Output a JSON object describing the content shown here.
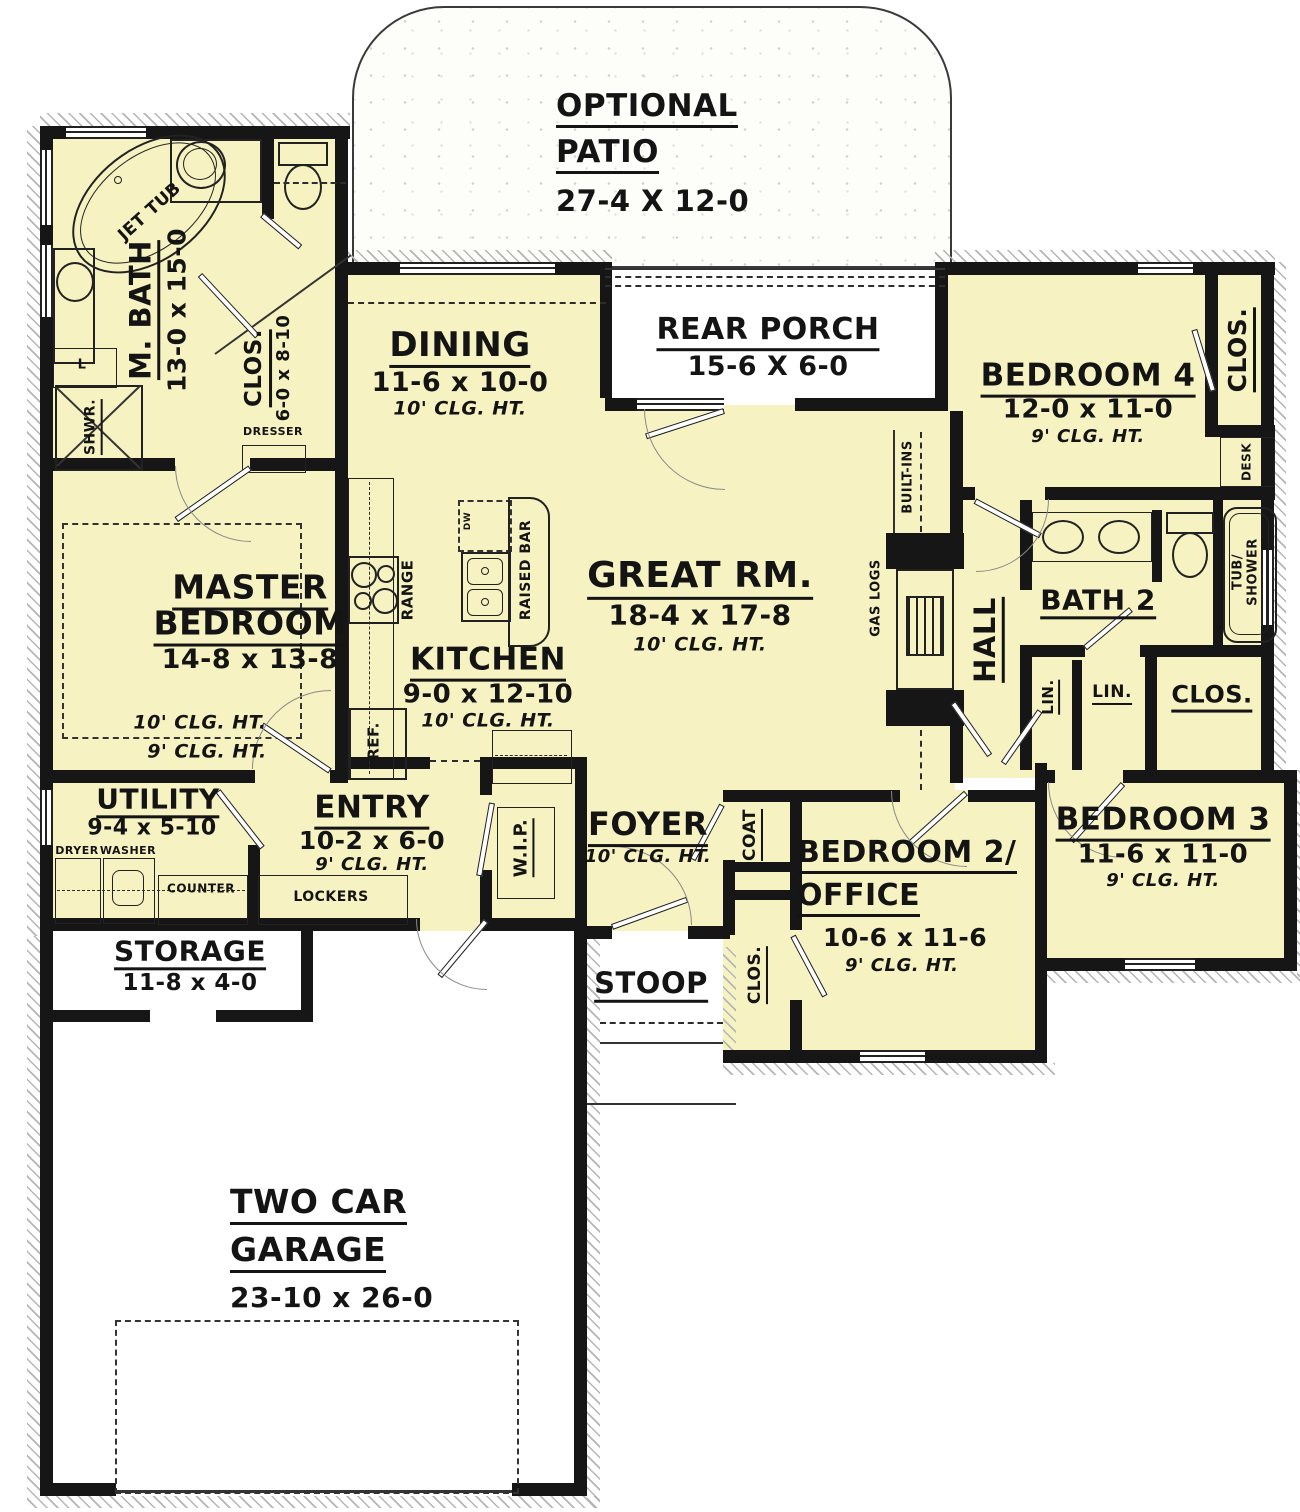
{
  "colors": {
    "room_fill": "#F6F2C2",
    "wall": "#161616",
    "exterior": "#FFFFFF"
  },
  "labels": {
    "patio": {
      "name1": "OPTIONAL",
      "name2": "PATIO",
      "dims": "27-4 X 12-0"
    },
    "mbath": {
      "name": "M. BATH",
      "dims": "13-0 x 15-0"
    },
    "mclos": {
      "name": "CLOS.",
      "dims": "6-0 x 8-10"
    },
    "dresser": "DRESSER",
    "shower": "SHWR.",
    "jettub": "JET TUB",
    "linen_l": "L",
    "master": {
      "name1": "MASTER",
      "name2": "BEDROOM",
      "dims": "14-8 x 13-8",
      "clg10": "10' CLG. HT.",
      "clg9": "9' CLG. HT."
    },
    "dining": {
      "name": "DINING",
      "dims": "11-6 x 10-0",
      "clg": "10' CLG. HT."
    },
    "porch": {
      "name": "REAR PORCH",
      "dims": "15-6 X 6-0"
    },
    "great": {
      "name": "GREAT RM.",
      "dims": "18-4 x 17-8",
      "clg": "10' CLG. HT."
    },
    "kitchen": {
      "name": "KITCHEN",
      "dims": "9-0 x 12-10",
      "clg": "10' CLG. HT."
    },
    "range": "RANGE",
    "ref": "REF.",
    "raisedbar": "RAISED BAR",
    "dw": "DW",
    "builtins": "BUILT-INS",
    "gaslogs": "GAS LOGS",
    "bed4": {
      "name": "BEDROOM 4",
      "dims": "12-0 x 11-0",
      "clg": "9' CLG. HT."
    },
    "bed4clos": "CLOS.",
    "desk": "DESK",
    "bath2": "BATH 2",
    "hall": "HALL",
    "lin1": "LIN.",
    "lin2": "LIN.",
    "hallclos": "CLOS.",
    "tubshower": {
      "line1": "TUB/",
      "line2": "SHOWER"
    },
    "bed3": {
      "name": "BEDROOM 3",
      "dims": "11-6 x 11-0",
      "clg": "9' CLG. HT."
    },
    "bed2": {
      "name1": "BEDROOM 2/",
      "name2": "OFFICE",
      "dims": "10-6 x 11-6",
      "clg": "9' CLG. HT."
    },
    "coat": "COAT",
    "bed2clos": "CLOS.",
    "foyer": {
      "name": "FOYER",
      "clg": "10' CLG. HT."
    },
    "wip": "W.I.P.",
    "entry": {
      "name": "ENTRY",
      "dims": "10-2 x 6-0",
      "clg": "9' CLG. HT."
    },
    "lockers": "LOCKERS",
    "utility": {
      "name": "UTILITY",
      "dims": "9-4 x 5-10"
    },
    "dryer": "DRYER",
    "washer": "WASHER",
    "counter": "COUNTER",
    "storage": {
      "name": "STORAGE",
      "dims": "11-8 x 4-0"
    },
    "stoop": "STOOP",
    "garage": {
      "name1": "TWO CAR",
      "name2": "GARAGE",
      "dims": "23-10 x 26-0"
    }
  }
}
